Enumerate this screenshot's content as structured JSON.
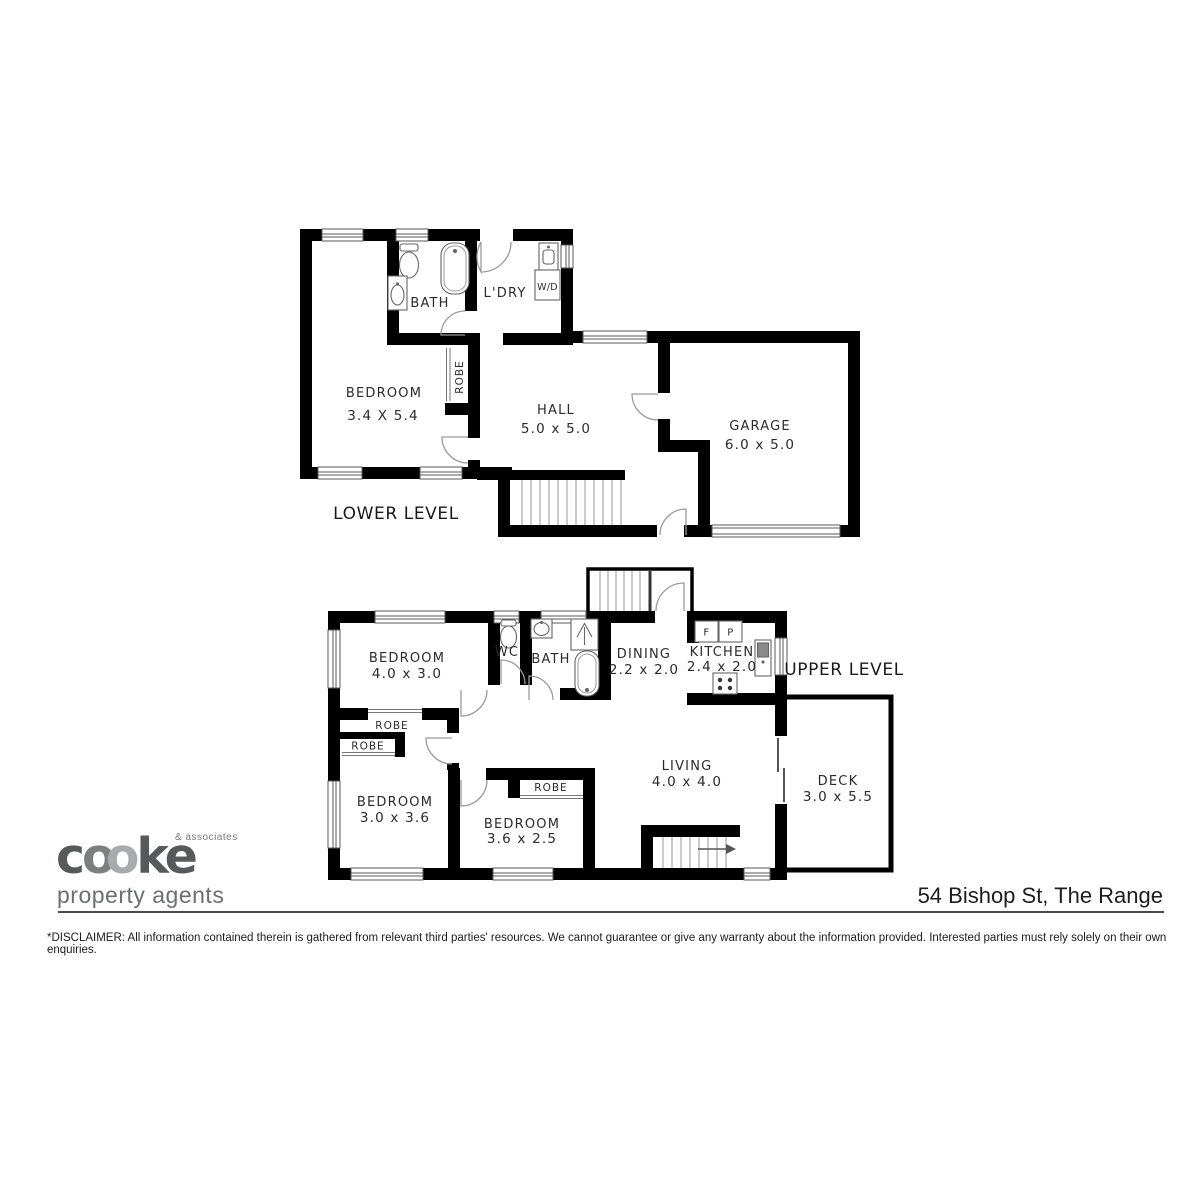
{
  "meta": {
    "title": "54 Bishop St, The Range floor plan"
  },
  "lower": {
    "level_label": "LOWER LEVEL",
    "bedroom": {
      "name": "BEDROOM",
      "dims": "3.4 X 5.4"
    },
    "bath": {
      "name": "BATH"
    },
    "ldry": {
      "name": "L'DRY"
    },
    "wd": {
      "name": "W/D"
    },
    "robe": {
      "name": "ROBE"
    },
    "hall": {
      "name": "HALL",
      "dims": "5.0 x 5.0"
    },
    "garage": {
      "name": "GARAGE",
      "dims": "6.0 x 5.0"
    }
  },
  "upper": {
    "level_label": "UPPER LEVEL",
    "bedroom1": {
      "name": "BEDROOM",
      "dims": "4.0 x 3.0"
    },
    "wc": {
      "name": "WC"
    },
    "bath": {
      "name": "BATH"
    },
    "dining": {
      "name": "DINING",
      "dims": "2.2 x 2.0"
    },
    "kitchen": {
      "name": "KITCHEN",
      "dims": "2.4 x 2.0"
    },
    "fridge_label": "F",
    "pantry_label": "P",
    "robe1": {
      "name": "ROBE"
    },
    "robe2": {
      "name": "ROBE"
    },
    "robe3": {
      "name": "ROBE"
    },
    "bedroom2": {
      "name": "BEDROOM",
      "dims": "3.0 x 3.6"
    },
    "bedroom3": {
      "name": "BEDROOM",
      "dims": "3.6 x 2.5"
    },
    "living": {
      "name": "LIVING",
      "dims": "4.0 x 4.0"
    },
    "deck": {
      "name": "DECK",
      "dims": "3.0 x 5.5"
    }
  },
  "footer": {
    "address": "54 Bishop St, The Range",
    "disclaimer": "*DISCLAIMER: All information contained therein is gathered from relevant third parties' resources. We cannot guarantee or give any warranty about the information provided. Interested parties must rely solely on their own enquiries."
  },
  "logo": {
    "letters": [
      "c",
      "o",
      "o",
      "k",
      "e"
    ],
    "associates": "& associates",
    "tagline": "property agents",
    "colors": {
      "dark_letters": "#58595b",
      "o_first": "#7c7e80",
      "o_second": "#a8aaad",
      "tagline": "#6d6e71"
    }
  },
  "plan_colors": {
    "wall": "#000000",
    "door_arc": "#9a9a9a",
    "fixture_stroke": "#666666",
    "stair_tread": "#a8a8a8"
  }
}
